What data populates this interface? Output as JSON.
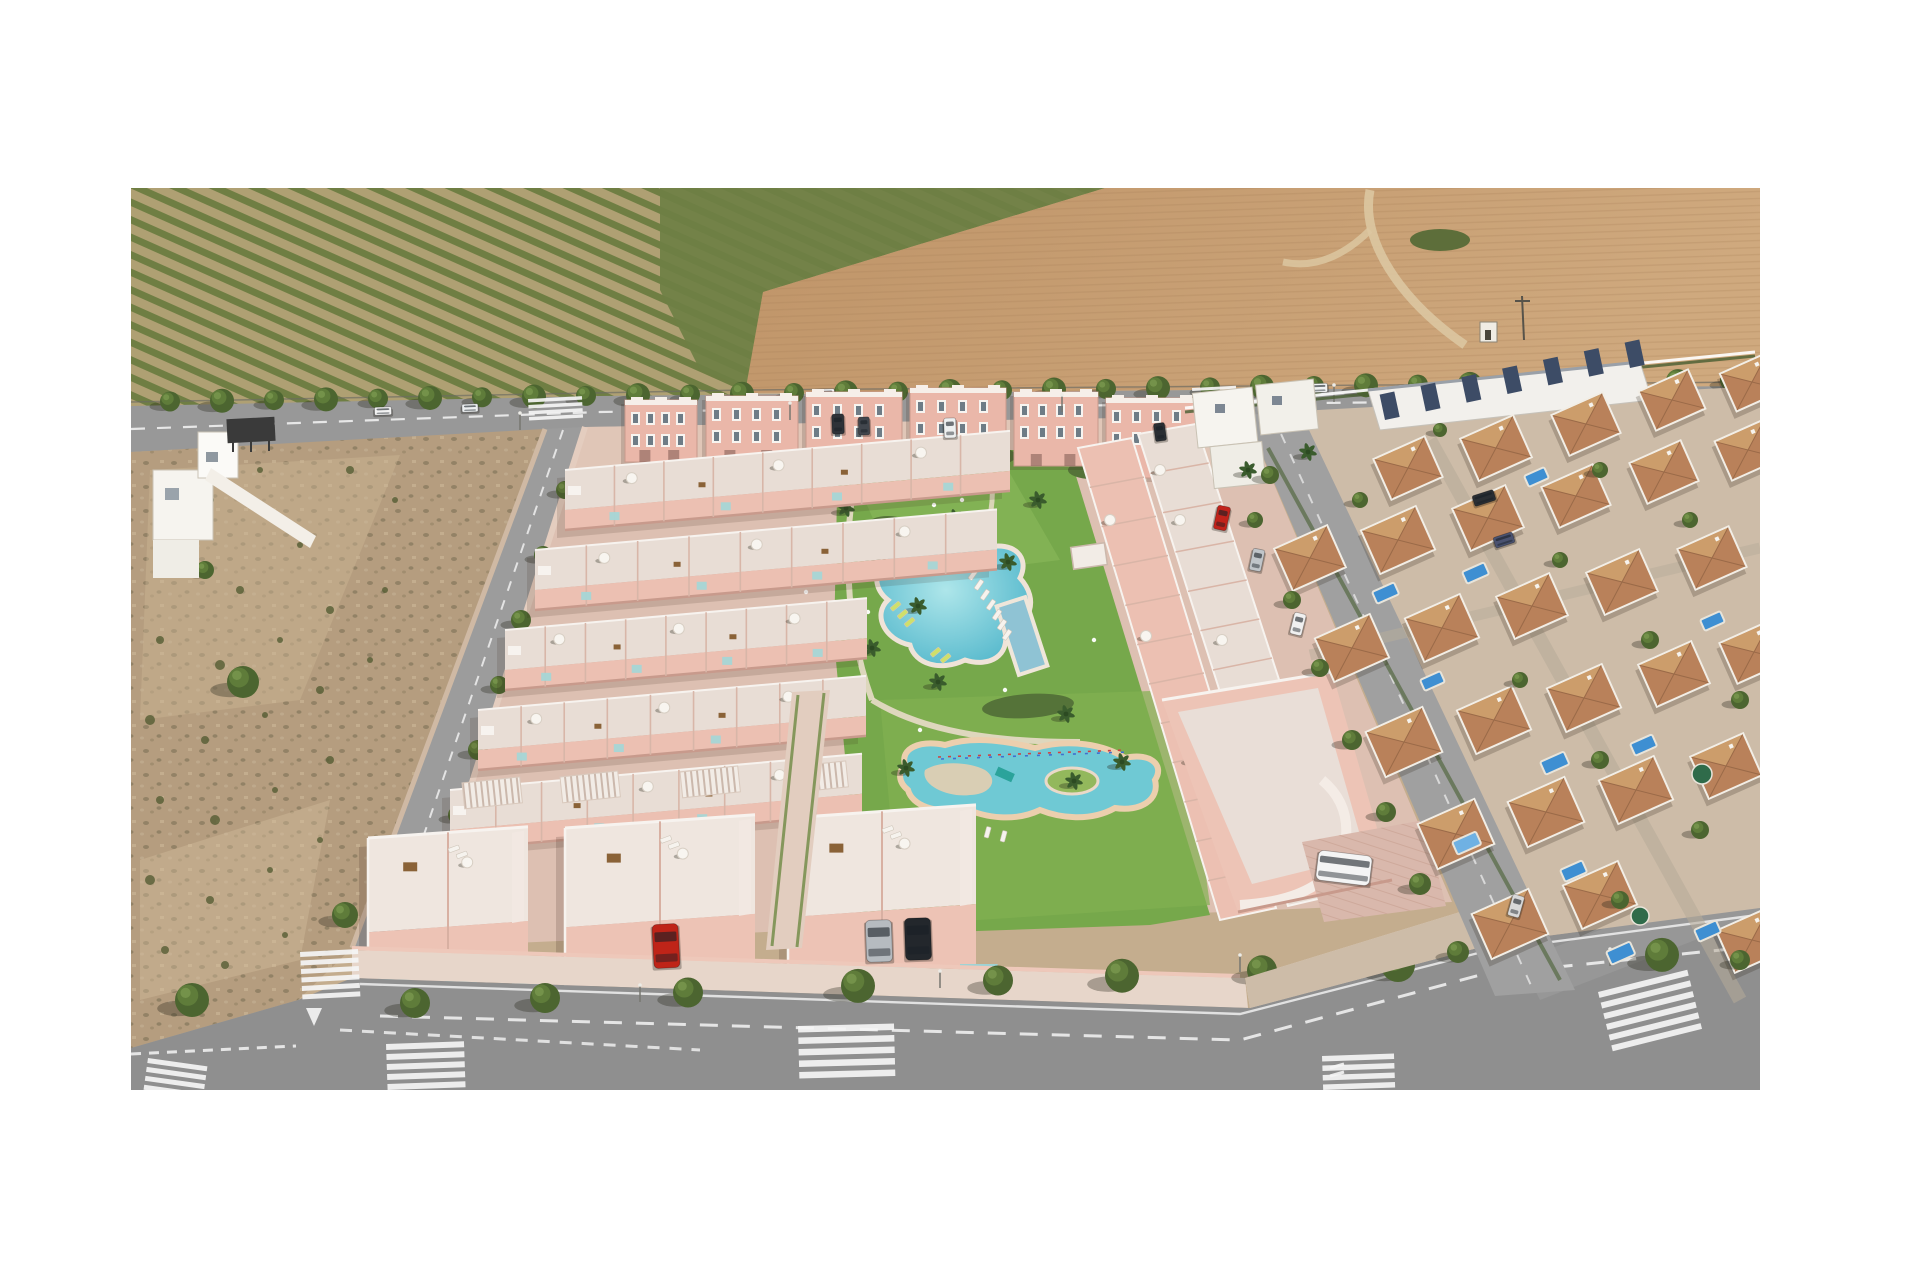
{
  "image": {
    "domain": "Natural-Image",
    "description": "Aerial 3D architectural render of a new-build salmon-pink townhouse and apartment development with a communal lagoon pool, kids lazy-river pool and gardens, bordered by an orchard and plowed farmland above a tree-lined road, vacant scrubland to the left, an existing white villa neighbourhood with terracotta roofs to the right, and streets with zebra crosswalks at the bottom. White margins surround the photo.",
    "frame": {
      "x": 131,
      "y": 188,
      "width": 1629,
      "height": 902
    },
    "background": "#ffffff"
  },
  "palette": {
    "white_bg": "#ffffff",
    "orchard_soil": "#b3a176",
    "orchard_rows": "#6c7c41",
    "shrub_green": "#6e7f44",
    "field_brown": "#c2986d",
    "field_light": "#cfa87e",
    "dirt_track": "#dcc7a1",
    "road": "#989898",
    "road_dark": "#8d8d8d",
    "marking": "#f5f5f5",
    "tree_dark": "#4c6530",
    "tree_light": "#5f7c3a",
    "shadow": "rgba(35,35,22,0.32)",
    "scrub": "#b59d7f",
    "scrub_light": "#d0bb9b",
    "bush": "#555c33",
    "dev_wall": "#ecc0b2",
    "dev_wall_shade": "#c89a8c",
    "deck": "#e8ddd5",
    "deck_light": "#efe6df",
    "white_trim": "#f7f3ef",
    "glass_teal": "#a6d6d6",
    "pavement": "#ddc0b2",
    "sidewalk": "#e7d6ca",
    "lawn": "#76a84b",
    "lawn_light": "#8cba5c",
    "hedge": "#557339",
    "pool_main": "#62c1d2",
    "pool_light": "#bfe9ec",
    "kids_pool": "#6fc9d4",
    "kids_rim": "#eccfae",
    "lap_pool": "#8fc3d4",
    "villa_wall": "#f2eee6",
    "villa_roof": "#b9815a",
    "villa_roof_light": "#cfa26f",
    "navy_panel": "#3d4c66",
    "pool_blue": "#3e8fd2",
    "tarp_blue": "#6fb1e3",
    "car_red": "#bf2418",
    "car_silver": "#b6bbc0",
    "car_black": "#23272c",
    "car_white": "#f2f2f2"
  },
  "regions": [
    {
      "name": "orchard-field",
      "label": "orchard with diagonal tree rows, top left"
    },
    {
      "name": "plowed-field",
      "label": "brown plowed farmland, top right, with dirt track and small shed"
    },
    {
      "name": "top-road",
      "label": "tree-lined avenue separating farmland from the plots"
    },
    {
      "name": "scrub-lot",
      "label": "vacant sandy scrubland, left, with white villa and billboard"
    },
    {
      "name": "development",
      "label": "new salmon-pink development: apartment blocks, townhouse rows, roof terraces"
    },
    {
      "name": "amenity-garden",
      "label": "communal garden with lagoon pool, kids pool, palms, loungers"
    },
    {
      "name": "neighborhood",
      "label": "existing white villas with terracotta roofs and private pools, right"
    },
    {
      "name": "bottom-road",
      "label": "foreground street with zebra crossings, sidewalk trees, parked cars"
    }
  ],
  "roads": {
    "top_tree_xs_upper": [
      170,
      222,
      274,
      326,
      378,
      430,
      482,
      534,
      586,
      638,
      690,
      742,
      794,
      846,
      898,
      950,
      1002,
      1054,
      1106,
      1158,
      1210,
      1262,
      1314,
      1366,
      1418,
      1470,
      1522,
      1574,
      1626,
      1678,
      1730
    ],
    "top_tree_xs_lower": [
      196,
      248,
      300,
      404,
      456,
      508,
      560,
      612,
      664,
      716,
      768,
      820,
      872,
      924,
      976,
      1028,
      1080,
      1132,
      1184,
      1236,
      1288,
      1340,
      1392,
      1444,
      1496,
      1548,
      1600,
      1652,
      1704,
      1748
    ],
    "sidewalk_tree_xs": [
      415,
      545,
      688,
      858,
      998,
      1122,
      1262,
      1398,
      1532,
      1662
    ],
    "top_cars": [
      [
        383,
        411,
        17,
        8,
        -2,
        "#f2f2f2"
      ],
      [
        470,
        408,
        16,
        8,
        -2,
        "#eceff0"
      ],
      [
        824,
        394,
        21,
        10,
        -2,
        "#f6f6f6"
      ],
      [
        1318,
        388,
        19,
        9,
        -2,
        "#f0f2f2"
      ],
      [
        1663,
        390,
        21,
        10,
        -2,
        "#f4f4f4"
      ]
    ],
    "streetlights_top": [
      [
        520,
        430
      ],
      [
        790,
        420
      ],
      [
        1062,
        412
      ],
      [
        1334,
        402
      ],
      [
        1606,
        394
      ]
    ],
    "streetlights_bottom": [
      [
        640,
        1002
      ],
      [
        940,
        988
      ],
      [
        1240,
        972
      ],
      [
        1610,
        966
      ]
    ],
    "crosswalks": [
      {
        "x": 300,
        "y": 952,
        "w": 58,
        "h": 5,
        "gap": 3.5,
        "n": 6,
        "rot": -3
      },
      {
        "x": 386,
        "y": 1044,
        "w": 78,
        "h": 6,
        "gap": 4,
        "n": 5,
        "rot": -2
      },
      {
        "x": 798,
        "y": 1026,
        "w": 96,
        "h": 6.5,
        "gap": 5,
        "n": 5,
        "rot": -1.5
      },
      {
        "x": 1322,
        "y": 1056,
        "w": 72,
        "h": 5.5,
        "gap": 4,
        "n": 4,
        "rot": -2
      },
      {
        "x": 1598,
        "y": 992,
        "w": 92,
        "h": 6,
        "gap": 5,
        "n": 6,
        "rot": -14
      },
      {
        "x": 148,
        "y": 1058,
        "w": 60,
        "h": 5,
        "gap": 4,
        "n": 4,
        "rot": 8
      },
      {
        "x": 528,
        "y": 399,
        "w": 54,
        "h": 3.5,
        "gap": 2.5,
        "n": 4,
        "rot": -3
      },
      {
        "x": 1192,
        "y": 388,
        "w": 44,
        "h": 3,
        "gap": 2.5,
        "n": 4,
        "rot": -3
      }
    ]
  },
  "scrub": {
    "bushes": [
      [
        160,
        480,
        5
      ],
      [
        210,
        500,
        4
      ],
      [
        260,
        470,
        3
      ],
      [
        180,
        560,
        6
      ],
      [
        240,
        590,
        4
      ],
      [
        300,
        545,
        3
      ],
      [
        350,
        470,
        4
      ],
      [
        395,
        500,
        3
      ],
      [
        160,
        640,
        4
      ],
      [
        220,
        665,
        5
      ],
      [
        280,
        640,
        3
      ],
      [
        330,
        610,
        4
      ],
      [
        385,
        590,
        3
      ],
      [
        150,
        720,
        5
      ],
      [
        205,
        740,
        4
      ],
      [
        265,
        715,
        3
      ],
      [
        320,
        690,
        4
      ],
      [
        370,
        660,
        3
      ],
      [
        160,
        800,
        4
      ],
      [
        215,
        820,
        5
      ],
      [
        275,
        790,
        3
      ],
      [
        330,
        760,
        4
      ],
      [
        150,
        880,
        5
      ],
      [
        210,
        900,
        4
      ],
      [
        270,
        870,
        3
      ],
      [
        320,
        840,
        3
      ],
      [
        165,
        950,
        4
      ],
      [
        225,
        965,
        4
      ],
      [
        285,
        935,
        3
      ]
    ],
    "trees": [
      [
        243,
        682,
        16
      ],
      [
        192,
        1000,
        17
      ],
      [
        205,
        570,
        9
      ],
      [
        345,
        915,
        13
      ]
    ]
  },
  "development": {
    "townhouse_rows": [
      {
        "x": 565,
        "y": 470,
        "len": 445
      },
      {
        "x": 535,
        "y": 550,
        "len": 462
      },
      {
        "x": 505,
        "y": 630,
        "len": 362
      },
      {
        "x": 478,
        "y": 710,
        "len": 388
      },
      {
        "x": 450,
        "y": 790,
        "len": 412
      }
    ],
    "apartment_blocks": [
      [
        625,
        400,
        72,
        62
      ],
      [
        706,
        396,
        92,
        66
      ],
      [
        806,
        392,
        96,
        68
      ],
      [
        910,
        388,
        96,
        70
      ],
      [
        1014,
        392,
        84,
        74
      ],
      [
        1106,
        398,
        92,
        80
      ]
    ],
    "pergolas": [
      [
        462,
        783
      ],
      [
        560,
        777
      ],
      [
        680,
        772
      ],
      [
        788,
        767
      ]
    ],
    "front_blocks": [
      [
        368,
        838,
        160,
        152
      ],
      [
        565,
        828,
        190,
        160
      ],
      [
        788,
        818,
        188,
        160
      ]
    ],
    "right_rows": [
      {
        "outer": [
          [
            1138,
            434
          ],
          [
            1196,
            424
          ],
          [
            1348,
            892
          ],
          [
            1288,
            906
          ]
        ],
        "fill": "#e8ddd5",
        "divs": 12
      },
      {
        "outer": [
          [
            1078,
            448
          ],
          [
            1132,
            438
          ],
          [
            1276,
            908
          ],
          [
            1220,
            920
          ]
        ],
        "fill": "#ecc0b2",
        "divs": 12
      }
    ],
    "right_row_parasols": [
      [
        1180,
        520
      ],
      [
        1222,
        640
      ],
      [
        1262,
        748
      ],
      [
        1160,
        470
      ],
      [
        1110,
        520
      ],
      [
        1146,
        636
      ],
      [
        1190,
        760
      ]
    ],
    "street_trees": [
      [
        565,
        490,
        9
      ],
      [
        543,
        555,
        9
      ],
      [
        521,
        620,
        10
      ],
      [
        499,
        685,
        9
      ],
      [
        478,
        750,
        10
      ],
      [
        457,
        815,
        9
      ],
      [
        437,
        878,
        10
      ]
    ],
    "cars": [
      [
        666,
        946,
        26,
        44,
        -3,
        "#bf2418"
      ],
      [
        879,
        941,
        26,
        42,
        -2,
        "#b6bbc0"
      ],
      [
        918,
        939,
        26,
        42,
        -2,
        "#23272c"
      ],
      [
        838,
        424,
        12,
        20,
        -2,
        "#2e3238"
      ],
      [
        864,
        426,
        11,
        18,
        -2,
        "#41464d"
      ],
      [
        950,
        428,
        12,
        20,
        -2,
        "#eef0f0"
      ],
      [
        1160,
        432,
        11,
        18,
        -8,
        "#2a2e33"
      ]
    ],
    "suv": [
      1344,
      868,
      54,
      30,
      7,
      "#f4f4f4"
    ]
  },
  "amenity": {
    "palms": [
      [
        878,
        556
      ],
      [
        918,
        606
      ],
      [
        955,
        518
      ],
      [
        1008,
        562
      ],
      [
        872,
        648
      ],
      [
        938,
        682
      ],
      [
        1066,
        714
      ],
      [
        906,
        768
      ],
      [
        1122,
        762
      ],
      [
        1074,
        781
      ],
      [
        846,
        508
      ],
      [
        1038,
        500
      ]
    ],
    "main_pool_loungers": [
      [
        968,
        578
      ],
      [
        974,
        588
      ],
      [
        980,
        598
      ],
      [
        986,
        608
      ],
      [
        992,
        618
      ],
      [
        997,
        628
      ],
      [
        1002,
        638
      ]
    ],
    "lawn_loungers": [
      [
        890,
        608
      ],
      [
        897,
        616
      ],
      [
        904,
        624
      ],
      [
        930,
        654
      ],
      [
        940,
        660
      ]
    ],
    "kids_pool_loungers": [
      [
        936,
        822
      ],
      [
        952,
        828
      ],
      [
        968,
        833
      ],
      [
        984,
        837
      ],
      [
        1000,
        841
      ]
    ],
    "white_figures": [
      [
        903,
        545
      ],
      [
        1005,
        690
      ],
      [
        806,
        592
      ],
      [
        944,
        494
      ],
      [
        962,
        500
      ],
      [
        934,
        505
      ],
      [
        868,
        612
      ],
      [
        1094,
        640
      ],
      [
        920,
        730
      ]
    ]
  },
  "neighborhood": {
    "villas": [
      [
        1408,
        468,
        58
      ],
      [
        1496,
        448,
        60
      ],
      [
        1586,
        424,
        58
      ],
      [
        1672,
        400,
        56
      ],
      [
        1752,
        382,
        54
      ],
      [
        1310,
        558,
        60
      ],
      [
        1398,
        540,
        62
      ],
      [
        1488,
        518,
        60
      ],
      [
        1576,
        496,
        58
      ],
      [
        1664,
        472,
        58
      ],
      [
        1748,
        450,
        56
      ],
      [
        1352,
        648,
        62
      ],
      [
        1442,
        628,
        62
      ],
      [
        1532,
        606,
        60
      ],
      [
        1622,
        582,
        60
      ],
      [
        1712,
        558,
        58
      ],
      [
        1404,
        742,
        64
      ],
      [
        1494,
        720,
        62
      ],
      [
        1584,
        698,
        62
      ],
      [
        1674,
        674,
        60
      ],
      [
        1754,
        652,
        58
      ],
      [
        1456,
        834,
        64
      ],
      [
        1546,
        812,
        64
      ],
      [
        1636,
        790,
        62
      ],
      [
        1726,
        766,
        60
      ],
      [
        1510,
        924,
        64
      ],
      [
        1600,
        895,
        62
      ],
      [
        1752,
        940,
        60
      ]
    ],
    "pools": [
      [
        1372,
        592,
        24,
        13
      ],
      [
        1462,
        572,
        24,
        13
      ],
      [
        1540,
        762,
        26,
        14
      ],
      [
        1630,
        744,
        24,
        13
      ],
      [
        1524,
        476,
        22,
        12
      ],
      [
        1606,
        952,
        26,
        14
      ],
      [
        1694,
        930,
        24,
        13
      ],
      [
        1420,
        680,
        22,
        12
      ],
      [
        1700,
        620,
        22,
        12
      ],
      [
        1560,
        870,
        24,
        13
      ]
    ],
    "covered_pool": [
      1452,
      842,
      26,
      14
    ],
    "green_canopies": [
      [
        1640,
        916,
        9
      ],
      [
        1702,
        774,
        10
      ]
    ],
    "trees": [
      [
        1270,
        475,
        9
      ],
      [
        1255,
        520,
        8
      ],
      [
        1292,
        600,
        9
      ],
      [
        1320,
        668,
        9
      ],
      [
        1352,
        740,
        10
      ],
      [
        1386,
        812,
        10
      ],
      [
        1420,
        884,
        11
      ],
      [
        1458,
        952,
        11
      ],
      [
        1600,
        470,
        8
      ],
      [
        1690,
        520,
        8
      ],
      [
        1560,
        560,
        8
      ],
      [
        1650,
        640,
        9
      ],
      [
        1740,
        700,
        9
      ],
      [
        1600,
        760,
        9
      ],
      [
        1520,
        680,
        8
      ],
      [
        1700,
        830,
        9
      ],
      [
        1620,
        900,
        9
      ],
      [
        1740,
        960,
        10
      ],
      [
        1360,
        500,
        8
      ],
      [
        1440,
        430,
        7
      ]
    ],
    "cars": [
      [
        1222,
        518,
        13,
        24,
        12,
        "#c1231b"
      ],
      [
        1257,
        560,
        12,
        22,
        12,
        "#c0c5c9"
      ],
      [
        1298,
        624,
        12,
        22,
        14,
        "#f0f0f0"
      ],
      [
        1484,
        498,
        22,
        11,
        -18,
        "#2a2e33"
      ],
      [
        1504,
        540,
        20,
        11,
        -18,
        "#4a5270"
      ],
      [
        1516,
        906,
        12,
        22,
        16,
        "#d8d8d8"
      ]
    ],
    "navy_panels": 7,
    "white_cluster_palms": [
      [
        1248,
        470
      ],
      [
        1308,
        452
      ]
    ]
  }
}
